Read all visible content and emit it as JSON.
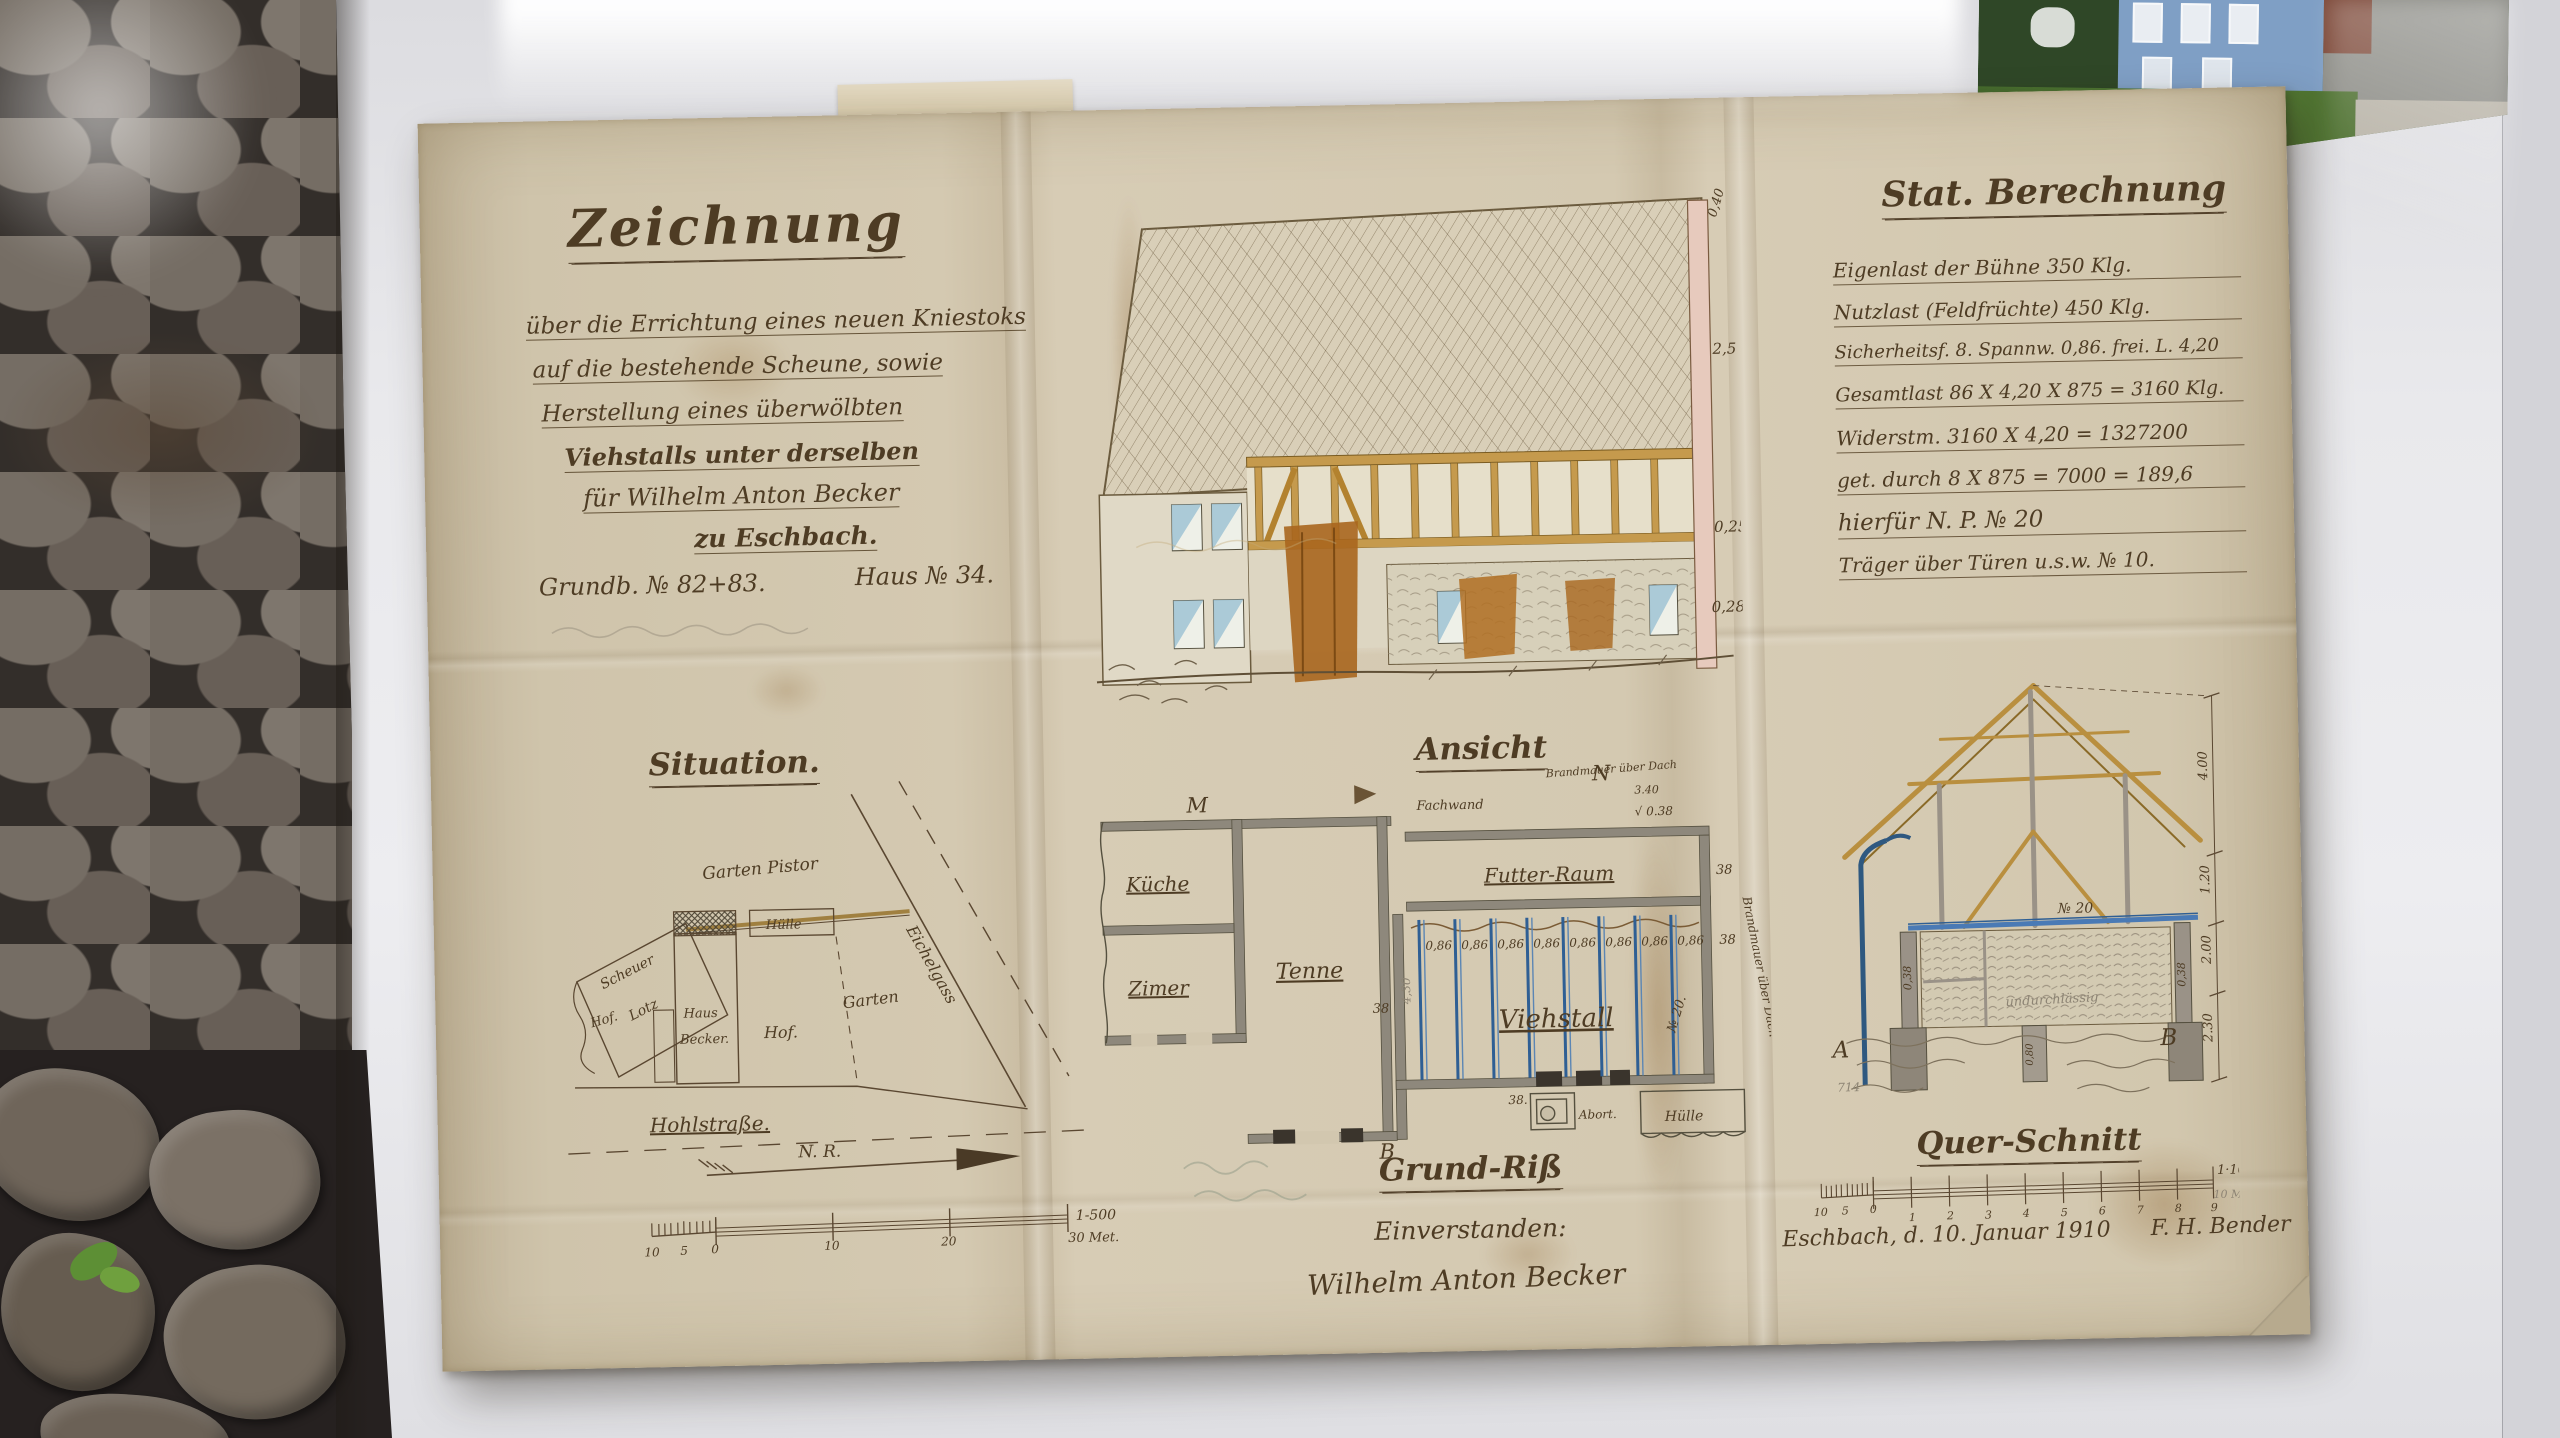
{
  "colors": {
    "ink": "#4e3c24",
    "paper": "#d2c7af",
    "wood": "#c59a4d",
    "steel_blue": "#2f5f94",
    "pencil": "#8d8474"
  },
  "title_block": {
    "title": "Zeichnung",
    "lines": [
      "über die Errichtung eines neuen Kniestoks",
      "auf die bestehende Scheune, sowie",
      "Herstellung eines überwölbten",
      "Viehstalls unter derselben",
      "für Wilhelm Anton Becker",
      "zu Eschbach."
    ],
    "registry": "Grundb. № 82+83.",
    "house_no": "Haus № 34."
  },
  "situation": {
    "heading": "Situation.",
    "garten_pistor": "Garten Pistor",
    "scheuer": "Scheuer",
    "lotz": "Lotz",
    "huelle": "Hülle",
    "haus": "Haus",
    "becker": "Becker.",
    "hof": "Hof.",
    "hof_left": "Hof.",
    "garten": "Garten",
    "eichelgass": "Eichelgass",
    "hohlstrasse": "Hohlstraße.",
    "north_label": "N. R.",
    "scale": {
      "t10": "10",
      "t5": "5",
      "t0": "0",
      "m10": "10",
      "m20": "20",
      "ratio": "1-500",
      "length": "30 Met."
    }
  },
  "ansicht": {
    "heading": "Ansicht",
    "dim_top": "0,40",
    "dim_mid": "2,5",
    "dim_low": "0,25",
    "dim_base": "0,28"
  },
  "grundriss": {
    "heading": "Grund-Riß",
    "marker_m": "M",
    "marker_n": "N",
    "marker_b": "B",
    "fachwand": "Fachwand",
    "brandmauer_top": "Brandmauer über Dach",
    "dim_340": "3.40",
    "dim_038": "√ 0.38",
    "kueche": "Küche",
    "zimer": "Zimer",
    "tenne": "Tenne",
    "futter_raum": "Futter-Raum",
    "viehstall": "Viehstall",
    "stall_dims": [
      "0,86",
      "0,86",
      "0,86",
      "0,86",
      "0,86",
      "0,86",
      "0,86",
      "0,86"
    ],
    "dim_38_a": "38",
    "dim_38_b": "38",
    "dim_38_c": "38",
    "dim_38_d": "38.",
    "dim_430": "4,30",
    "profile_no": "№ 20.",
    "brandmauer_side": "Brandmauer über Dach",
    "abort": "Abort.",
    "huelle": "Hülle",
    "consent": "Einverstanden:",
    "signature": "Wilhelm Anton Becker"
  },
  "stat": {
    "heading": "Stat. Berechnung",
    "lines": [
      "Eigenlast der Bühne 350 Klg.",
      "Nutzlast (Feldfrüchte) 450 Klg.",
      "Sicherheitsf. 8. Spannw. 0,86. frei. L. 4,20",
      "Gesamtlast 86 X 4,20 X 875 = 3160 Klg.",
      "Widerstm. 3160 X 4,20 = 1327200",
      "get. durch 8 X 875 = 7000 = 189,6",
      "hierfür N. P. № 20",
      "Träger über Türen u.s.w. № 10."
    ]
  },
  "querschnitt": {
    "heading": "Quer-Schnitt",
    "beam_no": "№ 20",
    "note": "undurchlässig",
    "wall_left": "0,38",
    "wall_right": "0,38",
    "pier": "0,80",
    "marker_a": "A",
    "marker_b": "B",
    "pencil_note": "714",
    "dims": [
      "4.00",
      "1.20",
      "2.00",
      "2.30"
    ],
    "scale": {
      "t10": "10",
      "t5": "5",
      "t0": "0",
      "ticks": [
        "1",
        "2",
        "3",
        "4",
        "5",
        "6",
        "7",
        "8",
        "9"
      ],
      "ratio": "1·100",
      "length": "10 M."
    },
    "date": "Eschbach, d. 10. Januar 1910",
    "author": "F. H. Bender"
  }
}
